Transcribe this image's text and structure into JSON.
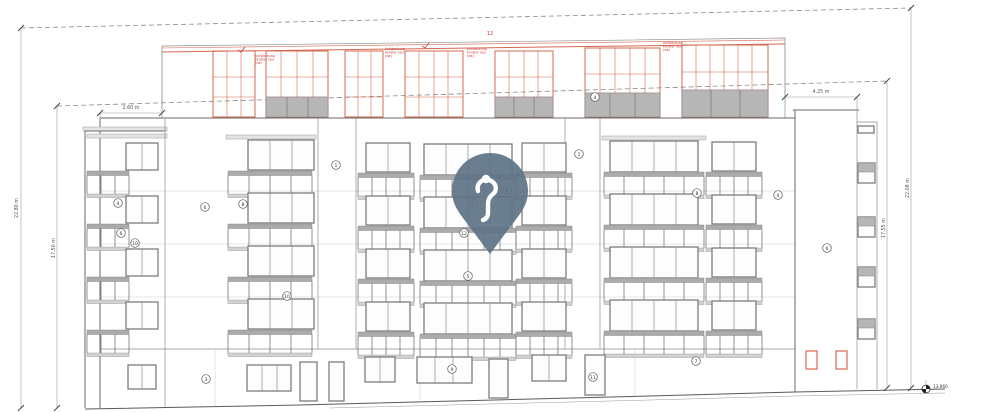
{
  "drawing": {
    "type": "building-elevation"
  },
  "colors": {
    "new_construction": "#d4694f",
    "note_red": "#cc3333",
    "pin": "#5e7386",
    "line_gray": "#8a8a8a"
  },
  "dimensions": {
    "left_outer": "22.80 m",
    "left_inner": "17.50 m",
    "right_outer": "22.08 m",
    "right_inner": "17.55 m",
    "roof_setback_left": "2.60 m",
    "roof_setback_right": "4.25 m"
  },
  "annotations": {
    "benchmark_level": "13.060",
    "sheet_ref": "12"
  },
  "markers": [
    {
      "label": "4",
      "x": 118,
      "y": 203
    },
    {
      "label": "6",
      "x": 121,
      "y": 233
    },
    {
      "label": "10",
      "x": 135,
      "y": 243
    },
    {
      "label": "6",
      "x": 205,
      "y": 207
    },
    {
      "label": "8",
      "x": 243,
      "y": 204
    },
    {
      "label": "1",
      "x": 336,
      "y": 165
    },
    {
      "label": "1",
      "x": 579,
      "y": 154
    },
    {
      "label": "4",
      "x": 595,
      "y": 97
    },
    {
      "label": "8",
      "x": 507,
      "y": 190
    },
    {
      "label": "5",
      "x": 473,
      "y": 203
    },
    {
      "label": "12",
      "x": 464,
      "y": 233
    },
    {
      "label": "5",
      "x": 468,
      "y": 276
    },
    {
      "label": "10",
      "x": 287,
      "y": 296
    },
    {
      "label": "8",
      "x": 697,
      "y": 193
    },
    {
      "label": "4",
      "x": 778,
      "y": 195
    },
    {
      "label": "6",
      "x": 827,
      "y": 248
    },
    {
      "label": "3",
      "x": 206,
      "y": 379
    },
    {
      "label": "9",
      "x": 452,
      "y": 369
    },
    {
      "label": "11",
      "x": 593,
      "y": 377
    },
    {
      "label": "7",
      "x": 696,
      "y": 361
    }
  ],
  "notes": [
    {
      "x": 255,
      "y": 57,
      "lines": [
        "Aufstockung",
        "Fenster neu",
        "(rot)"
      ]
    },
    {
      "x": 385,
      "y": 50,
      "lines": [
        "Aufstockung",
        "Fenster neu",
        "(rot)"
      ]
    },
    {
      "x": 467,
      "y": 50,
      "lines": [
        "Aufstockung",
        "Fenster neu",
        "(rot)"
      ]
    },
    {
      "x": 663,
      "y": 44,
      "lines": [
        "Aufstockung",
        "Fenster neu",
        "(rot)"
      ]
    }
  ],
  "icons": {
    "pin": "location-pin"
  }
}
